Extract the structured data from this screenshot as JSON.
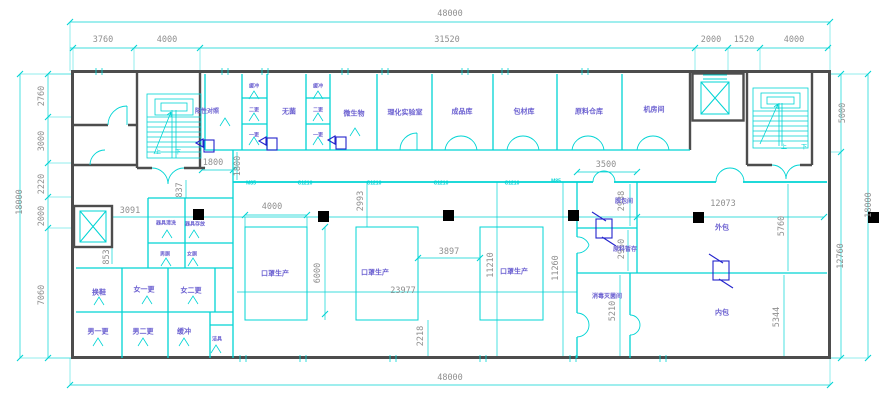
{
  "colors": {
    "line_cyan": "#00d4d4",
    "wall_gray": "#4d4d4d",
    "label_purple": "#6a5fd0",
    "dim_gray": "#8f8f8f",
    "passbox_blue": "#2323cc",
    "column_black": "#000000"
  },
  "dims": {
    "overall_width": "48000",
    "overall_height": "18000",
    "d3760": "3760",
    "d4000": "4000",
    "d31520": "31520",
    "d2000": "2000",
    "d1520": "1520",
    "v2760": "2760",
    "v3000": "3000",
    "v2220": "2220",
    "v7060": "7060",
    "v5000": "5000",
    "v12760": "12760",
    "d1800": "1800",
    "d837": "837",
    "d853": "853",
    "d3091": "3091",
    "d6000": "6000",
    "d2993": "2993",
    "d3897": "3897",
    "d23977": "23977",
    "d2218": "2218",
    "d11210": "11210",
    "d11260": "11260",
    "d3500": "3500",
    "d2938": "2938",
    "d2950": "2950",
    "d5210": "5210",
    "d12073": "12073",
    "d5760": "5760",
    "d5344": "5344"
  },
  "rooms": {
    "positive_control": "阳性对照",
    "buffer": "缓冲",
    "second_change": "二更",
    "first_change": "一更",
    "sterile": "无菌",
    "microbiology": "微生物",
    "physchem_lab": "理化实验室",
    "finished_goods": "成品库",
    "packaging_materials": "包材库",
    "raw_materials_warehouse": "原料仓库",
    "machine_room": "机房间",
    "mask_production": "口罩生产",
    "unpacking_room": "脱包间",
    "raw_material_staging": "原料暂存",
    "sterilization_room": "消毒灭菌间",
    "outer_packaging": "外包",
    "inner_packaging": "内包",
    "shoe_change": "换鞋",
    "women_first_change": "女一更",
    "women_second_change": "女二更",
    "men_first_change": "男一更",
    "men_second_change": "男二更",
    "cleaning_tools": "洁具",
    "equipment_washing": "器具清洗",
    "equipment_storage": "器具存放",
    "men_toilet": "男厕",
    "women_toilet": "女厕",
    "stair_up": "上",
    "stair_down": "下"
  },
  "tags": {
    "window_tag": "C1210",
    "door_tag": "M85"
  }
}
